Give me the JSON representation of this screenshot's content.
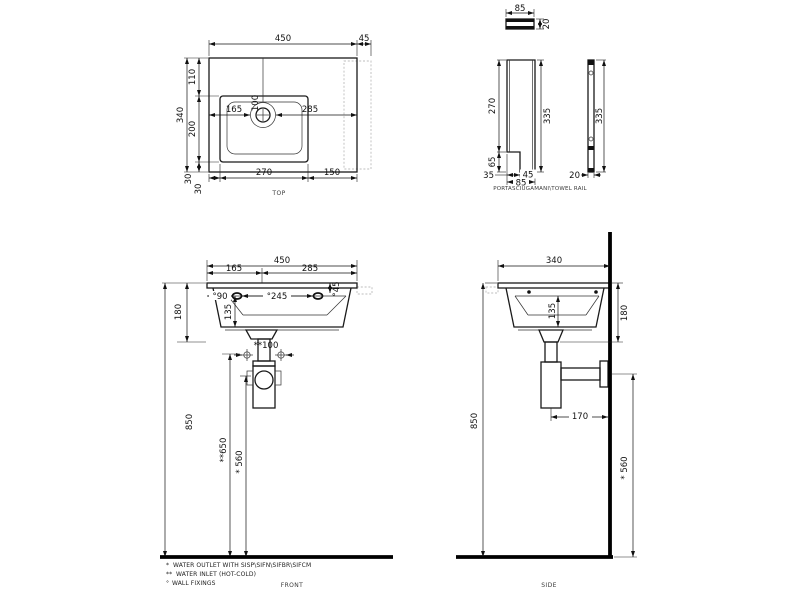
{
  "drawing": {
    "type": "sanitaryware technical drawing",
    "views": {
      "top": {
        "label": "TOP",
        "dim_450": "450",
        "dim_45": "45",
        "dim_110": "110",
        "dim_200": "200",
        "dim_340": "340",
        "dim_30_vertical": "30",
        "dim_30_horizontal": "30",
        "dim_270": "270",
        "dim_150": "150",
        "dim_165": "165",
        "dim_285": "285",
        "dim_100": "100"
      },
      "towel_rail": {
        "label": "PORTASCIUGAMANI\\TOWEL RAIL",
        "plan": {
          "dim_85": "85",
          "dim_20": "20"
        },
        "front": {
          "dim_270": "270",
          "dim_65": "65",
          "dim_35": "35",
          "dim_45": "45",
          "dim_85": "85",
          "dim_335": "335"
        },
        "side": {
          "dim_20": "20",
          "dim_335": "335"
        }
      },
      "front": {
        "label": "FRONT",
        "dim_450": "450",
        "dim_165": "165",
        "dim_285": "285",
        "dim_90": "°90",
        "dim_245": "°245",
        "dim_45": "°45",
        "dim_135": "135",
        "dim_180": "180",
        "dim_850": "850",
        "dim_100": "**100",
        "dim_650": "**650",
        "dim_560": "* 560"
      },
      "side": {
        "label": "SIDE",
        "dim_340": "340",
        "dim_135": "135",
        "dim_180": "180",
        "dim_850": "850",
        "dim_170": "170",
        "dim_560": "* 560"
      }
    },
    "notes": [
      {
        "marker": "*",
        "text": "WATER OUTLET WITH SISP\\SIFN\\SIFBR\\SIFCM"
      },
      {
        "marker": "**",
        "text": "WATER INLET  (HOT-COLD)"
      },
      {
        "marker": "°",
        "text": "WALL FIXINGS"
      }
    ],
    "colors": {
      "line": "#1a1a1a",
      "ghost": "#bdbdbd",
      "background": "#ffffff"
    }
  }
}
